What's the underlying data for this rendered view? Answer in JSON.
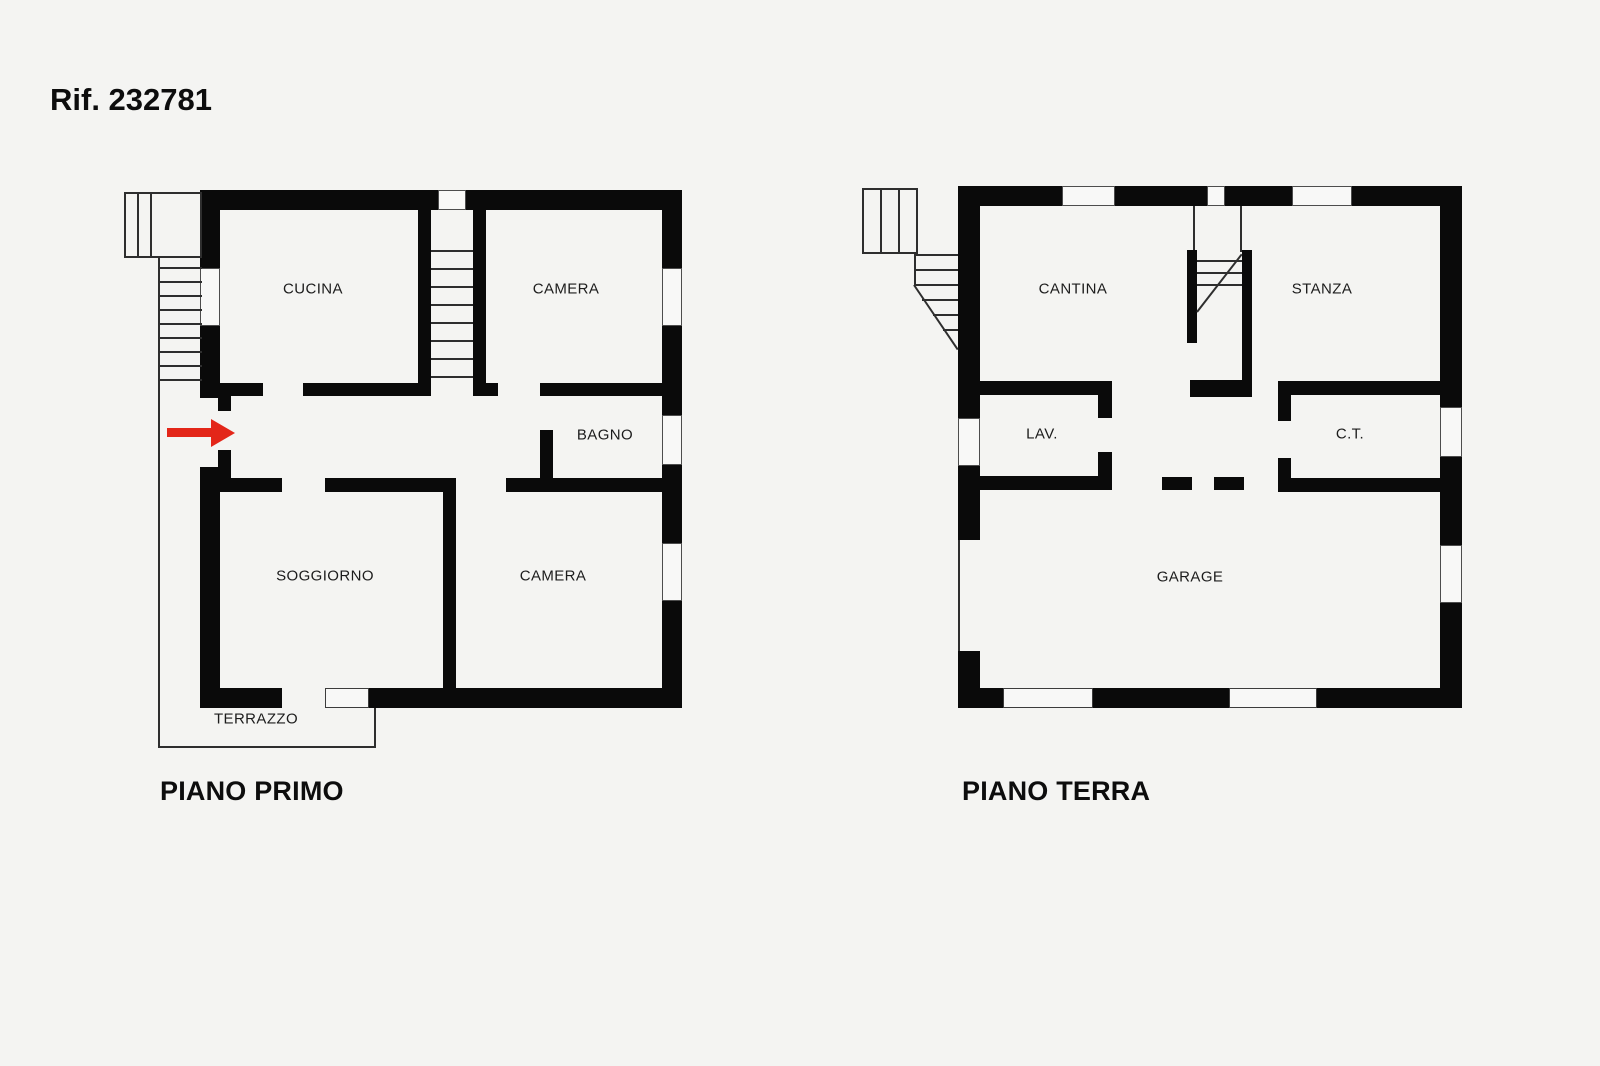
{
  "reference": "Rif. 232781",
  "floors": [
    {
      "name": "PIANO PRIMO",
      "rooms": [
        "CUCINA",
        "CAMERA",
        "BAGNO",
        "SOGGIORNO",
        "CAMERA",
        "TERRAZZO"
      ]
    },
    {
      "name": "PIANO TERRA",
      "rooms": [
        "CANTINA",
        "STANZA",
        "LAV.",
        "C.T.",
        "GARAGE"
      ]
    }
  ],
  "entrance": {
    "symbol": "arrow-right",
    "color": "#e32619"
  },
  "colors": {
    "wall": "#0a0a0a",
    "background": "#f4f4f2",
    "thin_line": "#2e2e2e"
  }
}
